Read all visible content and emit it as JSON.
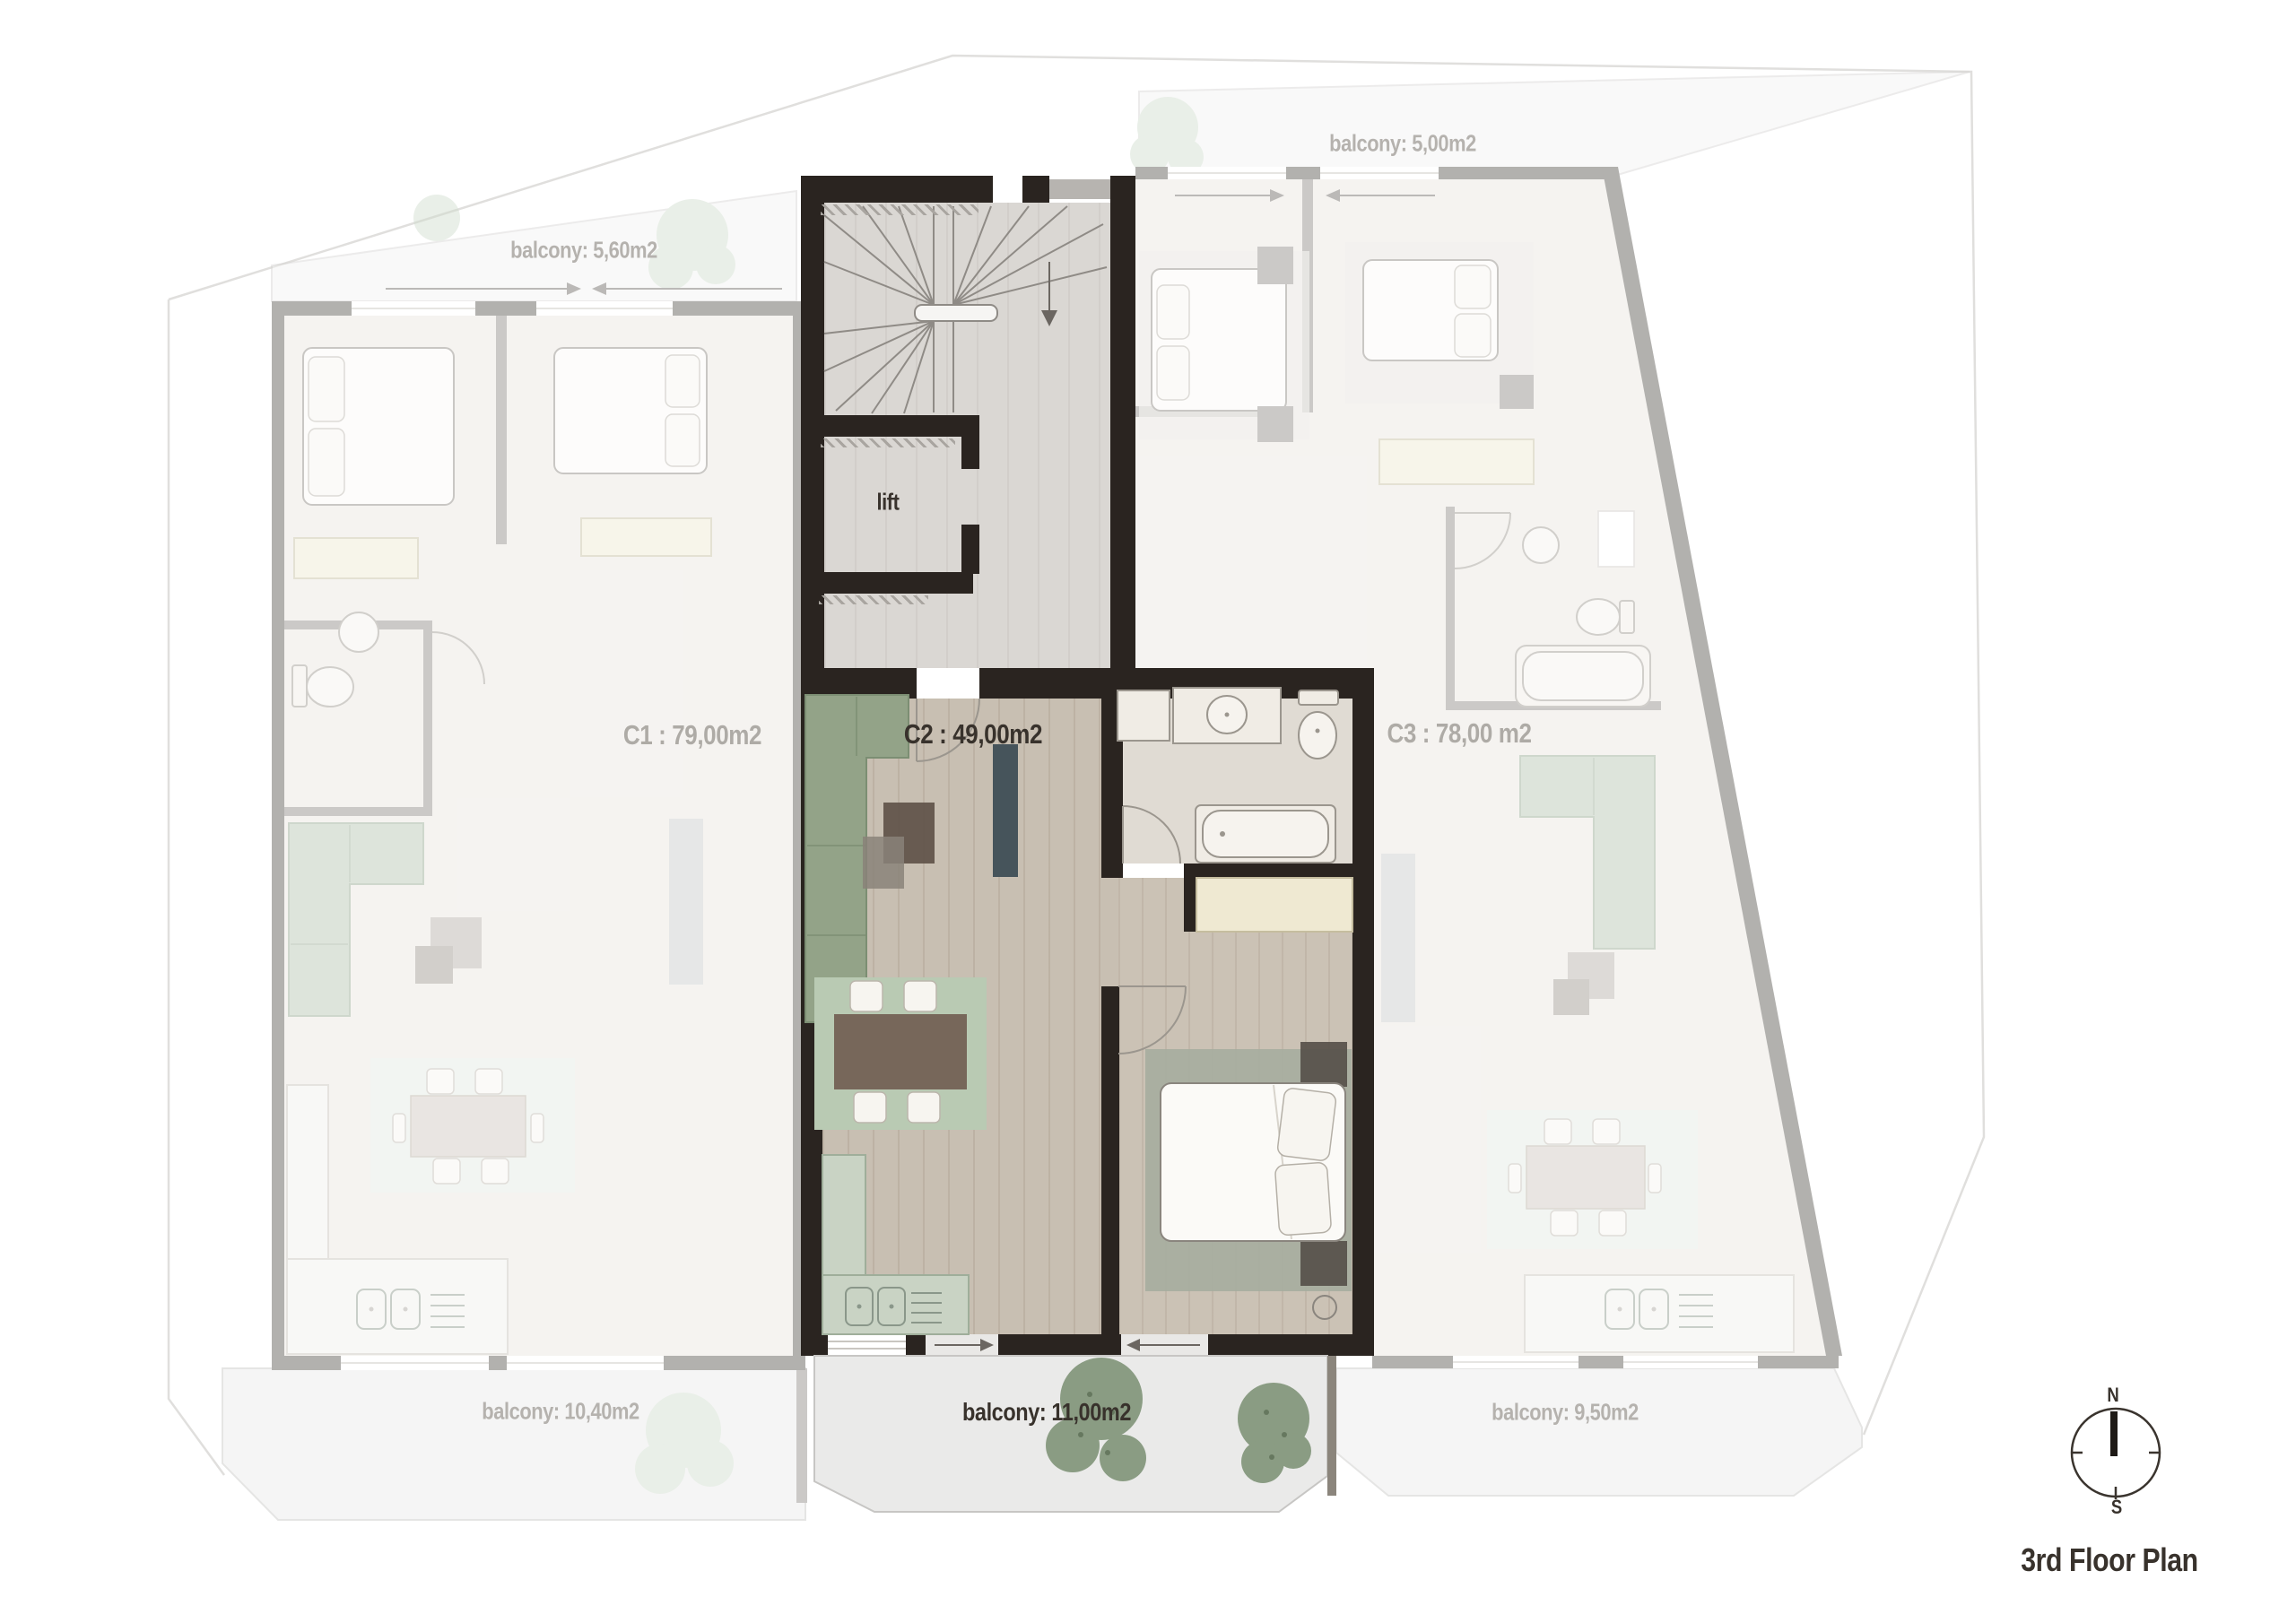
{
  "title": "3rd Floor Plan",
  "plan": {
    "units": {
      "c1": {
        "label": "C1 : 79,00m2",
        "highlighted": false
      },
      "c2": {
        "label": "C2 : 49,00m2",
        "highlighted": true
      },
      "c3": {
        "label": "C3 : 78,00 m2",
        "highlighted": false
      }
    },
    "core": {
      "lift": "lift"
    },
    "balconies": {
      "top_left": "balcony: 5,60m2",
      "top_right": "balcony: 5,00m2",
      "bottom_left": "balcony: 10,40m2",
      "bottom_center": "balcony: 11,00m2",
      "bottom_right": "balcony: 9,50m2"
    },
    "compass": {
      "north": "N",
      "south": "S"
    }
  },
  "colors": {
    "highlight_wall": "#2a2420",
    "faded_wall": "#a9a7a3",
    "wood_floor": "#c8bfb2",
    "sofa_green": "#93a388",
    "rug_green": "#b9cab3",
    "wardrobe_cream": "#efe9d2",
    "label_gray": "#b5b2ae",
    "label_dark": "#38322c"
  }
}
